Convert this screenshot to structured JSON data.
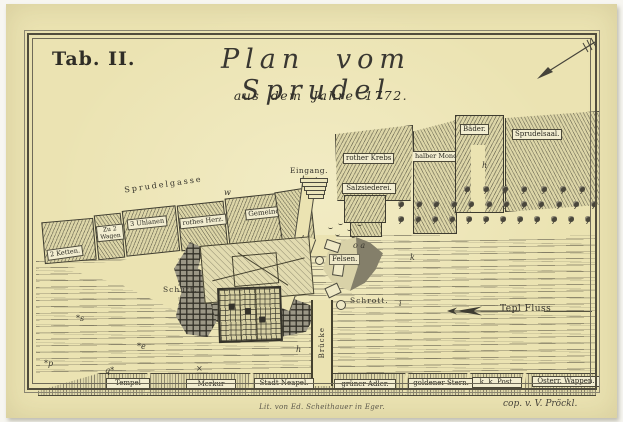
{
  "page": {
    "tab_label": "Tab. II.",
    "title": "Plan vom Sprudel",
    "subtitle": "aus dem Jahre 1772.",
    "credit_left": "Lit. von Ed. Scheithauer in Eger.",
    "credit_right": "cop. v. V. Pröckl."
  },
  "map": {
    "street_label": "Sprudelgasse",
    "upper_buildings": [
      {
        "label": "2 Ketten."
      },
      {
        "label": "Zu 2 Wagen"
      },
      {
        "label": "3 Uhlanen"
      },
      {
        "label": "rothes Herz."
      },
      {
        "label": "Gemeindebad."
      }
    ],
    "market_buildings": [
      {
        "label": "rother Krebs"
      },
      {
        "label": "halber Mond"
      },
      {
        "label": "Salzsiederei."
      },
      {
        "label": "Bäder."
      },
      {
        "label": "Sprudelsaal."
      }
    ],
    "features": {
      "entrance": "Eingang.",
      "debris_left": "Schutt.",
      "rocks": "Felsen.",
      "debris_right": "Schrott.",
      "river": "Tepl Fluss",
      "bridge": "Brücke"
    },
    "bottom_buildings": [
      {
        "label": "Tempel"
      },
      {
        "label": "Merkur"
      },
      {
        "label": "Stadt Neapel."
      },
      {
        "label": "grüner Adler."
      },
      {
        "label": "goldener Stern."
      },
      {
        "label": "k. k. Post."
      },
      {
        "label": "Österr. Wappen."
      }
    ],
    "markers": [
      "h",
      "h",
      "k",
      "i",
      "*s",
      "*e",
      "*p",
      "q*",
      "×",
      "w",
      "o a"
    ],
    "tree_rows": [
      7,
      12,
      12
    ],
    "colors": {
      "paper": "#ebe3b2",
      "ink": "#3e3c30",
      "label_box": "#f2edd0"
    }
  }
}
